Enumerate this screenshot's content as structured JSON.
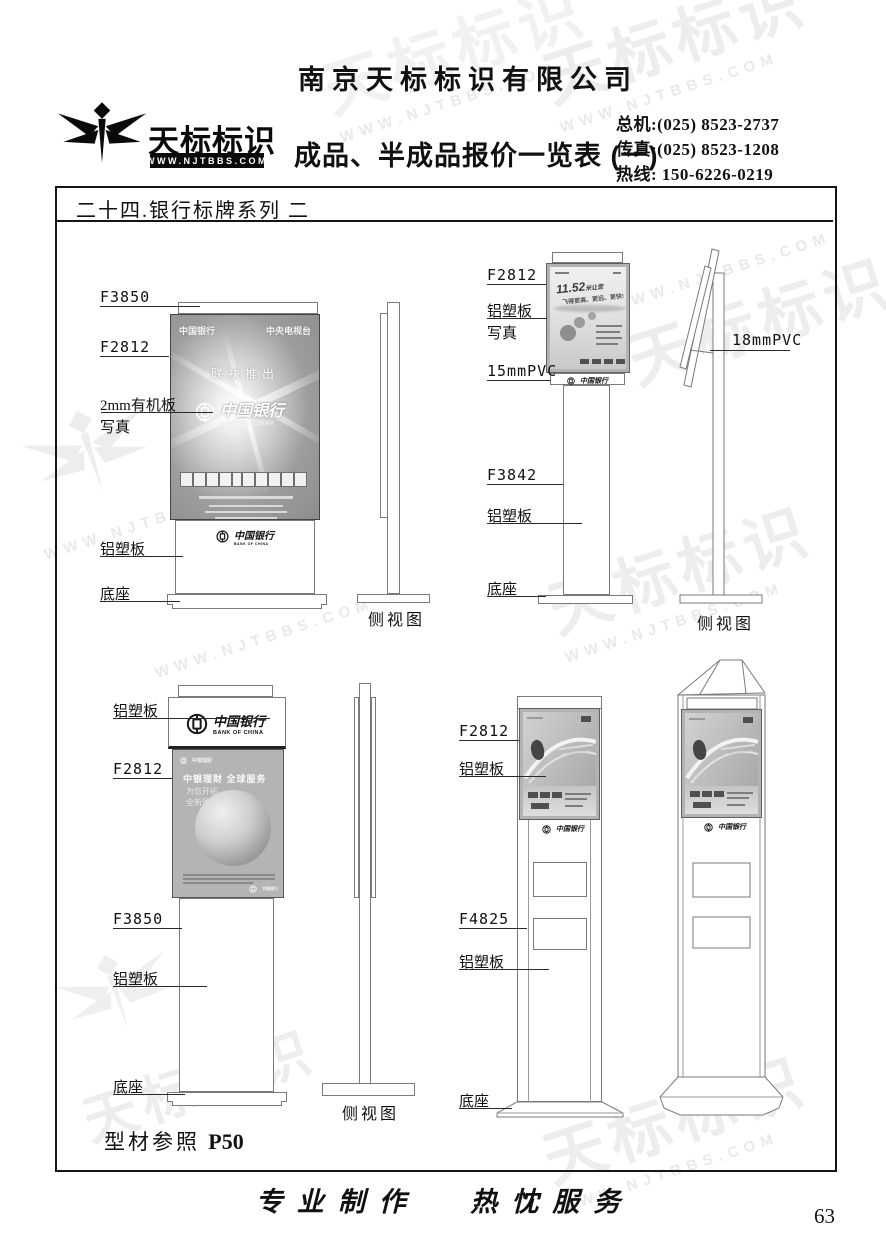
{
  "header": {
    "company": "南京天标标识有限公司",
    "title": "成品、半成品报价一览表 (一)",
    "brand": "天标标识",
    "brand_url": "WWW.NJTBBS.COM",
    "contacts": [
      {
        "label": "总机:",
        "value": "(025) 8523-2737"
      },
      {
        "label": "传真:",
        "value": "(025) 8523-1208"
      },
      {
        "label": "热线:",
        "value": "150-6226-0219"
      }
    ]
  },
  "section": {
    "title": "二十四.银行标牌系列 二"
  },
  "terms": {
    "f3850": "F3850",
    "f2812": "F2812",
    "f3842": "F3842",
    "f4825": "F4825",
    "pvc15": "15mmPVC",
    "pvc18": "18mmPVC",
    "alu": "铝塑板",
    "photo": "写真",
    "organic": "2mm有机板",
    "base": "底座",
    "side_view": "侧视图"
  },
  "bank": {
    "cn": "中国银行",
    "en": "BANK OF CHINA"
  },
  "posters": {
    "cctv": {
      "top_left": "中国银行",
      "top_right": "中央电视台",
      "presents": "联袂推出"
    },
    "plane": {
      "big": "11.52",
      "tail": "米让您",
      "line2": "飞得更高、更远、更快!"
    },
    "licai": {
      "brand": "中银理财",
      "headline": "中银理财 全球服务",
      "sub1": "为您开拓",
      "sub2": "全新理财视界"
    }
  },
  "footer": {
    "ref_label": "型材参照",
    "ref_page": "P50",
    "slogan_left": "专业制作",
    "slogan_right": "热忱服务",
    "page_number": "63"
  },
  "watermark": {
    "brand": "天标标识",
    "url": "WWW.NJTBBS.COM"
  }
}
